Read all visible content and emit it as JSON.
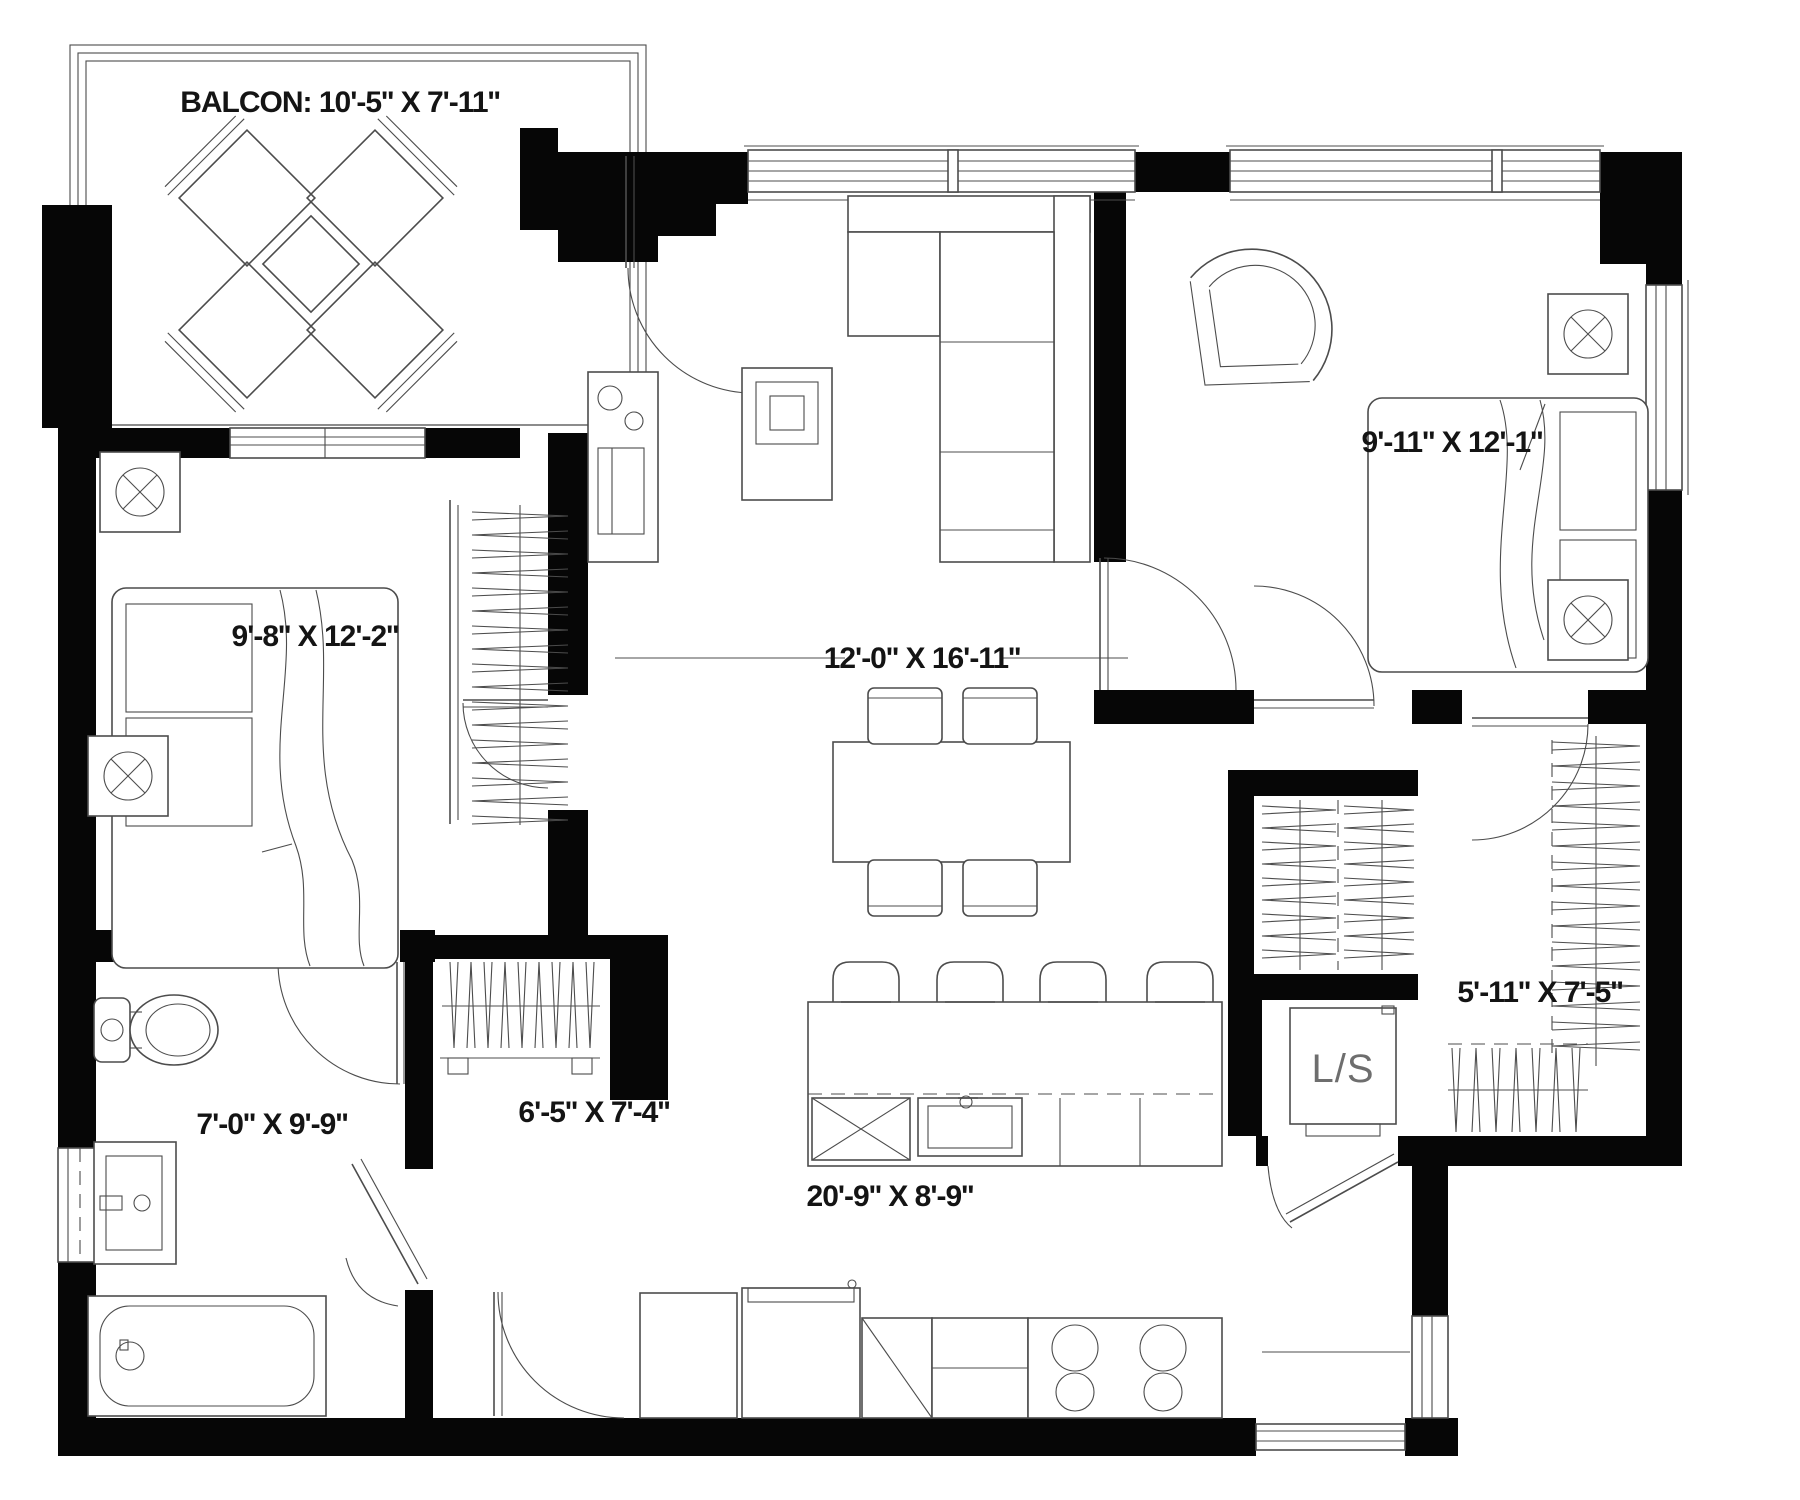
{
  "plan": {
    "type": "apartment-floor-plan",
    "colors": {
      "background": "#ffffff",
      "walls": "#060606",
      "lines": "#4c4c4c",
      "text": "#141414"
    },
    "rooms": {
      "balcony": {
        "name": "Balcony",
        "label": "BALCON: 10'-5'' X 7'-11''"
      },
      "bedroom_left": {
        "name": "Bedroom 1",
        "label": "9'-8'' X 12'-2''"
      },
      "living_dining": {
        "name": "Living / Dining",
        "label": "12'-0'' X 16'-11''"
      },
      "bedroom_right": {
        "name": "Bedroom 2",
        "label": "9'-11'' X 12'-1''"
      },
      "bathroom": {
        "name": "Bathroom",
        "label": "7'-0'' X 9'-9''"
      },
      "hall": {
        "name": "Hall",
        "label": "6'-5'' X 7'-4''"
      },
      "kitchen": {
        "name": "Kitchen",
        "label": "20'-9'' X 8'-9''"
      },
      "walk_in_closet": {
        "name": "Walk-in closet",
        "label": "5'-11'' X 7'-5''"
      },
      "laundry_storage": {
        "name": "Laundry / Storage",
        "label": "L/S"
      }
    }
  }
}
